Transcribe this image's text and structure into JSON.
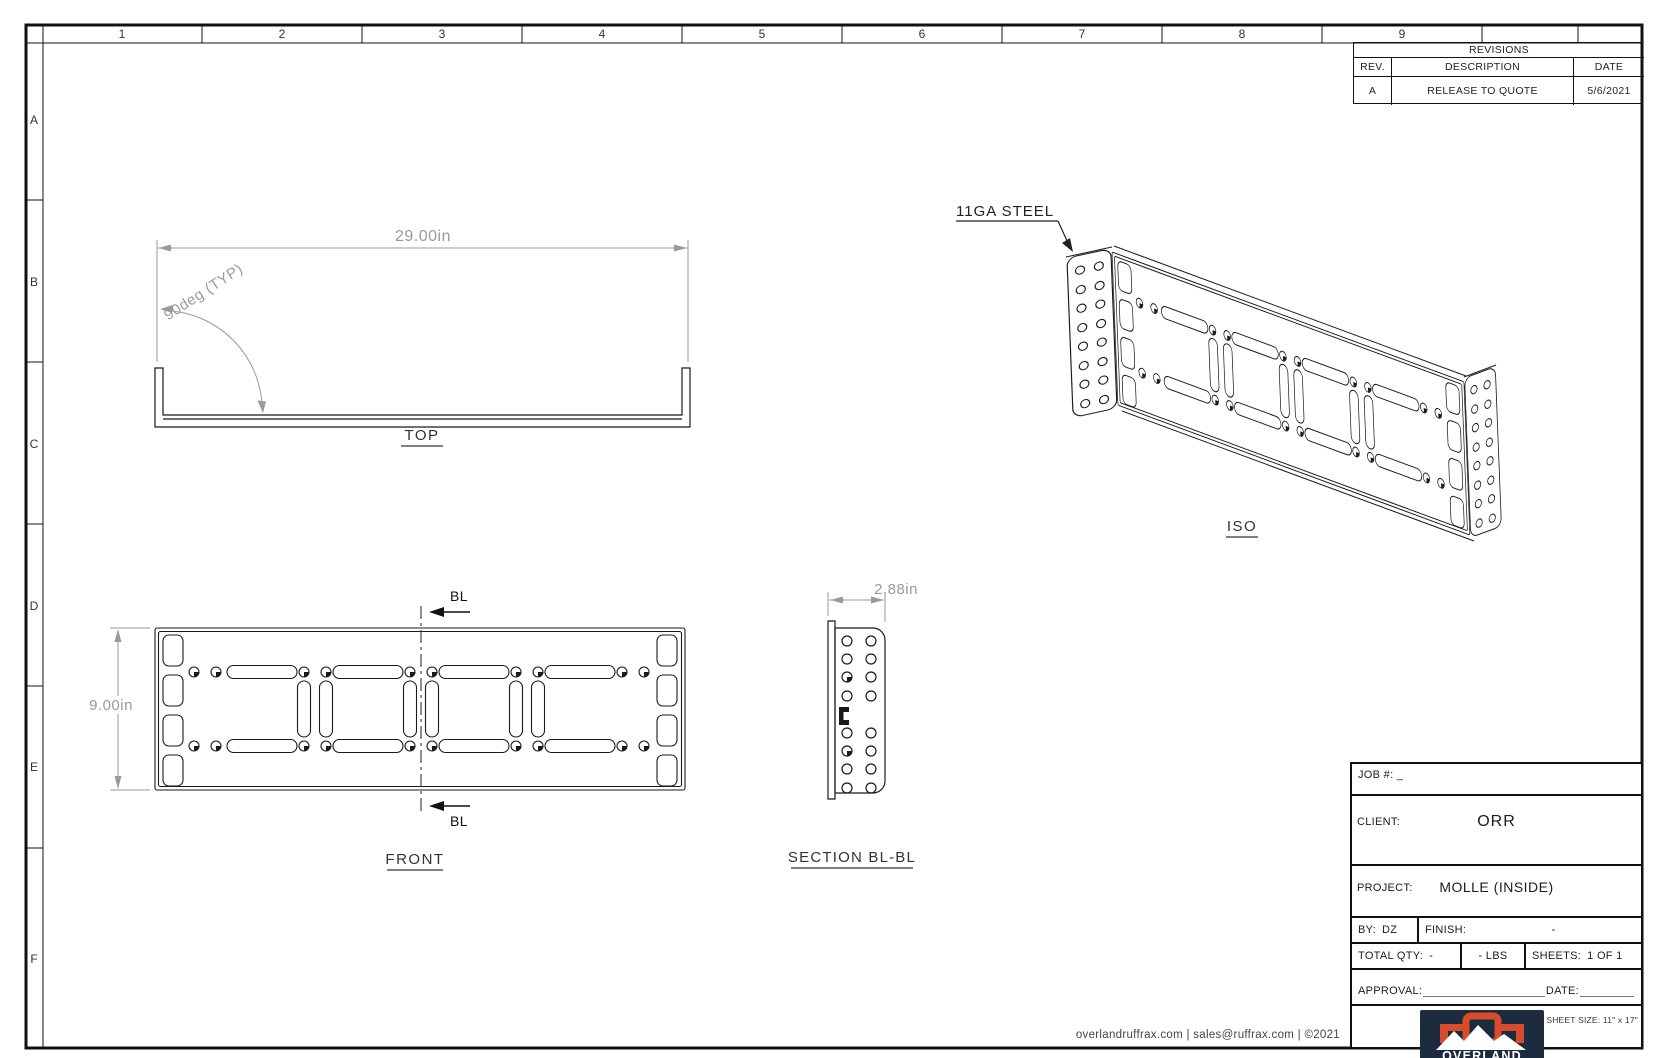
{
  "grid": {
    "columns": [
      "1",
      "2",
      "3",
      "4",
      "5",
      "6",
      "7",
      "8",
      "9"
    ],
    "rows": [
      "A",
      "B",
      "C",
      "D",
      "E",
      "F"
    ]
  },
  "revisions": {
    "title": "REVISIONS",
    "col_rev": "REV.",
    "col_description": "DESCRIPTION",
    "col_date": "DATE",
    "rows": [
      {
        "rev": "A",
        "description": "RELEASE TO QUOTE",
        "date": "5/6/2021"
      }
    ]
  },
  "views": {
    "top": {
      "label": "TOP",
      "width_dim": "29.00in",
      "angle_dim": "90deg (TYP)"
    },
    "front": {
      "label": "FRONT",
      "height_dim": "9.00in",
      "section_marker": "BL"
    },
    "section": {
      "label": "SECTION BL-BL",
      "depth_dim": "2.88in"
    },
    "iso": {
      "label": "ISO",
      "material_callout": "11GA STEEL"
    }
  },
  "title_block": {
    "job": {
      "label": "JOB #:",
      "value": "_"
    },
    "client": {
      "label": "CLIENT:",
      "value": "ORR"
    },
    "project": {
      "label": "PROJECT:",
      "value": "MOLLE (INSIDE)"
    },
    "by": {
      "label": "BY:",
      "value": "DZ"
    },
    "finish": {
      "label": "FINISH:",
      "value": "-"
    },
    "total_qty": {
      "label": "TOTAL QTY:",
      "value": "-"
    },
    "weight": "- LBS",
    "sheets": {
      "label": "SHEETS:",
      "value": "1 OF 1"
    },
    "approval_label": "APPROVAL:",
    "date_label": "DATE:",
    "sheet_size": "SHEET SIZE: 11\" x 17\""
  },
  "logo": {
    "brand": "OVERLAND",
    "sub": "RUFF RAX"
  },
  "footer": "overlandruffrax.com |  sales@ruffrax.com  |  ©2021",
  "colors": {
    "line": "#1a1a1a",
    "dim": "#9a9a9a",
    "navy": "#1d2b3f",
    "orange": "#d84b2d"
  }
}
